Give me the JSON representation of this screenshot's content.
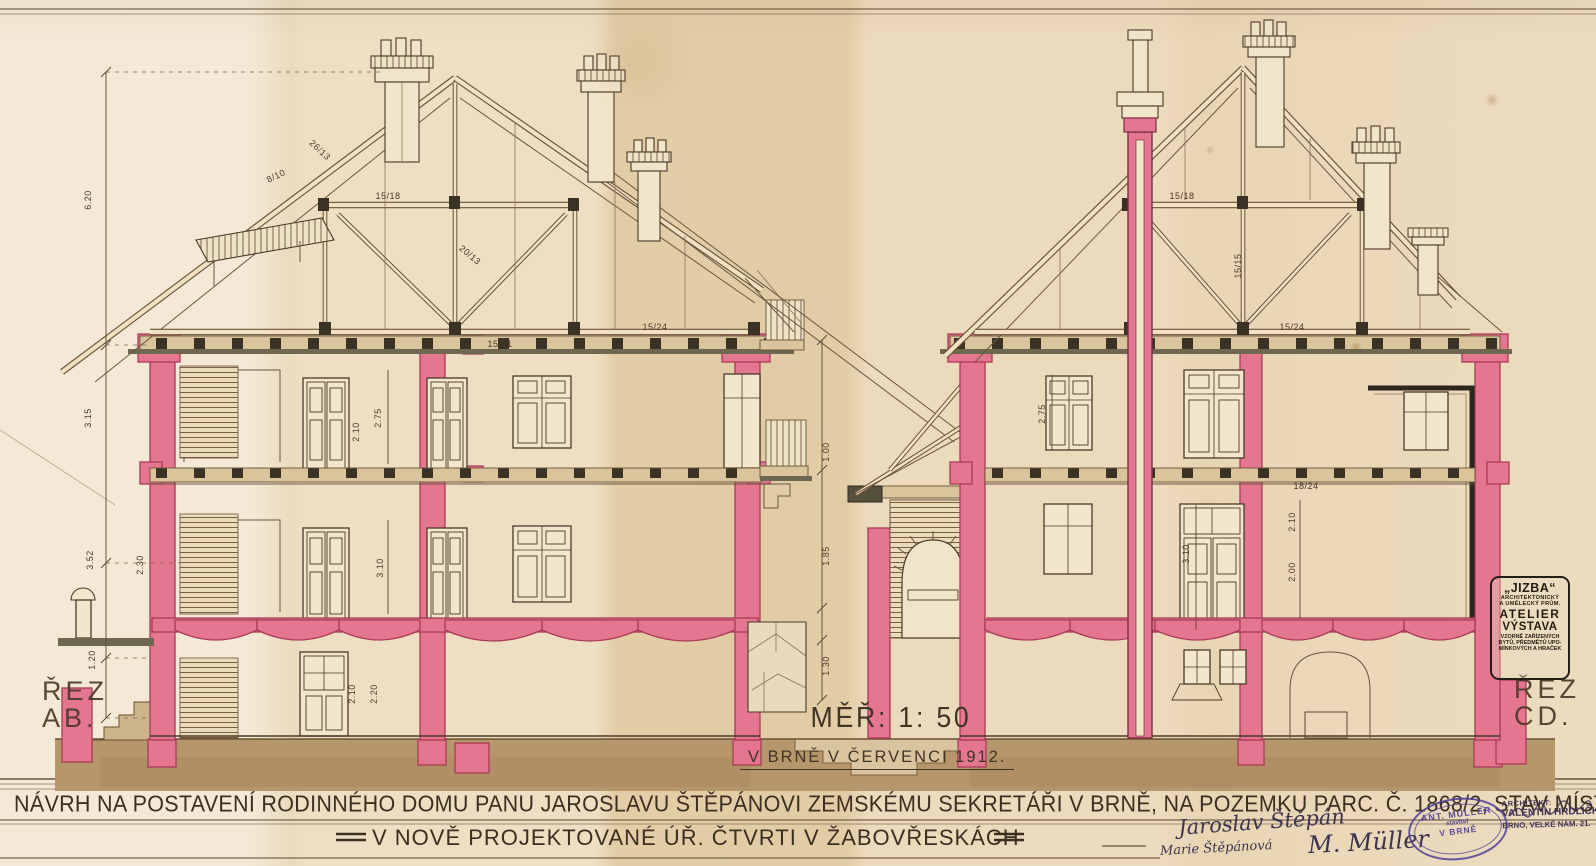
{
  "sheet": {
    "title_line1": "NÁVRH NA POSTAVENÍ RODINNÉHO DOMU PANU JAROSLAVU ŠTĚPÁNOVI ZEMSKÉMU SEKRETÁŘI V BRNĚ, NA POZEMKU PARC. Č. 1868/2, STAV MÍSTO II",
    "title_line2": "V NOVĚ PROJEKTOVANÉ ÚŘ. ČTVRTI V ŽABOVŘESKÁCH",
    "scale_label": "MĚŘ: 1: 50",
    "place_date": "V BRNĚ V ČERVENCI 1912.",
    "section_left": {
      "line1": "ŘEZ",
      "line2": "AB."
    },
    "section_right": {
      "line1": "ŘEZ",
      "line2": "CD."
    }
  },
  "stamps": {
    "jizba": {
      "lines": [
        "„JIZBA“",
        "ARCHITEKTONICKÝ",
        "A UMĚLECKÝ PRŮM.",
        "ATELIER",
        "VÝSTAVA",
        "VZORNĚ ZAŘÍZENÝCH",
        "BYTŮ, PŘEDMĚTŮ UPO-",
        "MÍNKOVÝCH A HRAČEK"
      ]
    },
    "builder": {
      "lines": [
        "ANT. MÜLLER",
        "stavitel",
        "V BRNĚ"
      ]
    },
    "architect": {
      "lines": [
        "ARCHITEKT:",
        "VALENTIN HRDLIČKA,",
        "BRNO, VELKÉ NÁM. 21."
      ]
    }
  },
  "signatures": [
    "Jaroslav Štěpán",
    "Marie Štěpánová",
    "M. Müller"
  ],
  "annotations": [
    {
      "t": "6.20",
      "x": 88,
      "y": 200,
      "r": -90
    },
    {
      "t": "3.15",
      "x": 88,
      "y": 418,
      "r": -90
    },
    {
      "t": "3.52",
      "x": 90,
      "y": 560,
      "r": -90
    },
    {
      "t": "1.20",
      "x": 92,
      "y": 660,
      "r": -90
    },
    {
      "t": "2.30",
      "x": 140,
      "y": 565,
      "r": -90
    },
    {
      "t": "26/13",
      "x": 320,
      "y": 150,
      "r": 43
    },
    {
      "t": "15/18",
      "x": 388,
      "y": 196,
      "r": 0
    },
    {
      "t": "8/10",
      "x": 276,
      "y": 176,
      "r": -25
    },
    {
      "t": "20/13",
      "x": 470,
      "y": 255,
      "r": 40
    },
    {
      "t": "15/21",
      "x": 500,
      "y": 344,
      "r": 0
    },
    {
      "t": "15/24",
      "x": 655,
      "y": 327,
      "r": 0
    },
    {
      "t": "2.75",
      "x": 378,
      "y": 418,
      "r": -90
    },
    {
      "t": "2.10",
      "x": 356,
      "y": 432,
      "r": -90
    },
    {
      "t": "3.10",
      "x": 380,
      "y": 568,
      "r": -90
    },
    {
      "t": "2.10",
      "x": 352,
      "y": 694,
      "r": -90
    },
    {
      "t": "2.20",
      "x": 374,
      "y": 694,
      "r": -90
    },
    {
      "t": "1.00",
      "x": 826,
      "y": 452,
      "r": -90
    },
    {
      "t": "1.85",
      "x": 826,
      "y": 556,
      "r": -90
    },
    {
      "t": "1.30",
      "x": 826,
      "y": 666,
      "r": -90
    },
    {
      "t": "15/18",
      "x": 1182,
      "y": 196,
      "r": 0
    },
    {
      "t": "15/15",
      "x": 1238,
      "y": 266,
      "r": -90
    },
    {
      "t": "15/24",
      "x": 1292,
      "y": 327,
      "r": 0
    },
    {
      "t": "18/24",
      "x": 1306,
      "y": 486,
      "r": 0
    },
    {
      "t": "2.75",
      "x": 1042,
      "y": 414,
      "r": -90
    },
    {
      "t": "3.10",
      "x": 1186,
      "y": 554,
      "r": -90
    },
    {
      "t": "2.10",
      "x": 1292,
      "y": 522,
      "r": -90
    },
    {
      "t": "2.00",
      "x": 1292,
      "y": 572,
      "r": -90
    }
  ],
  "colors": {
    "paper": "#ecdcbd",
    "ink": "#4a3a28",
    "wall_pink": "#e5768f",
    "wall_pink_dark": "#a93b58",
    "ground": "#b6976b",
    "stamp_purple": "#4f3f96",
    "olive": "#6e6850"
  }
}
